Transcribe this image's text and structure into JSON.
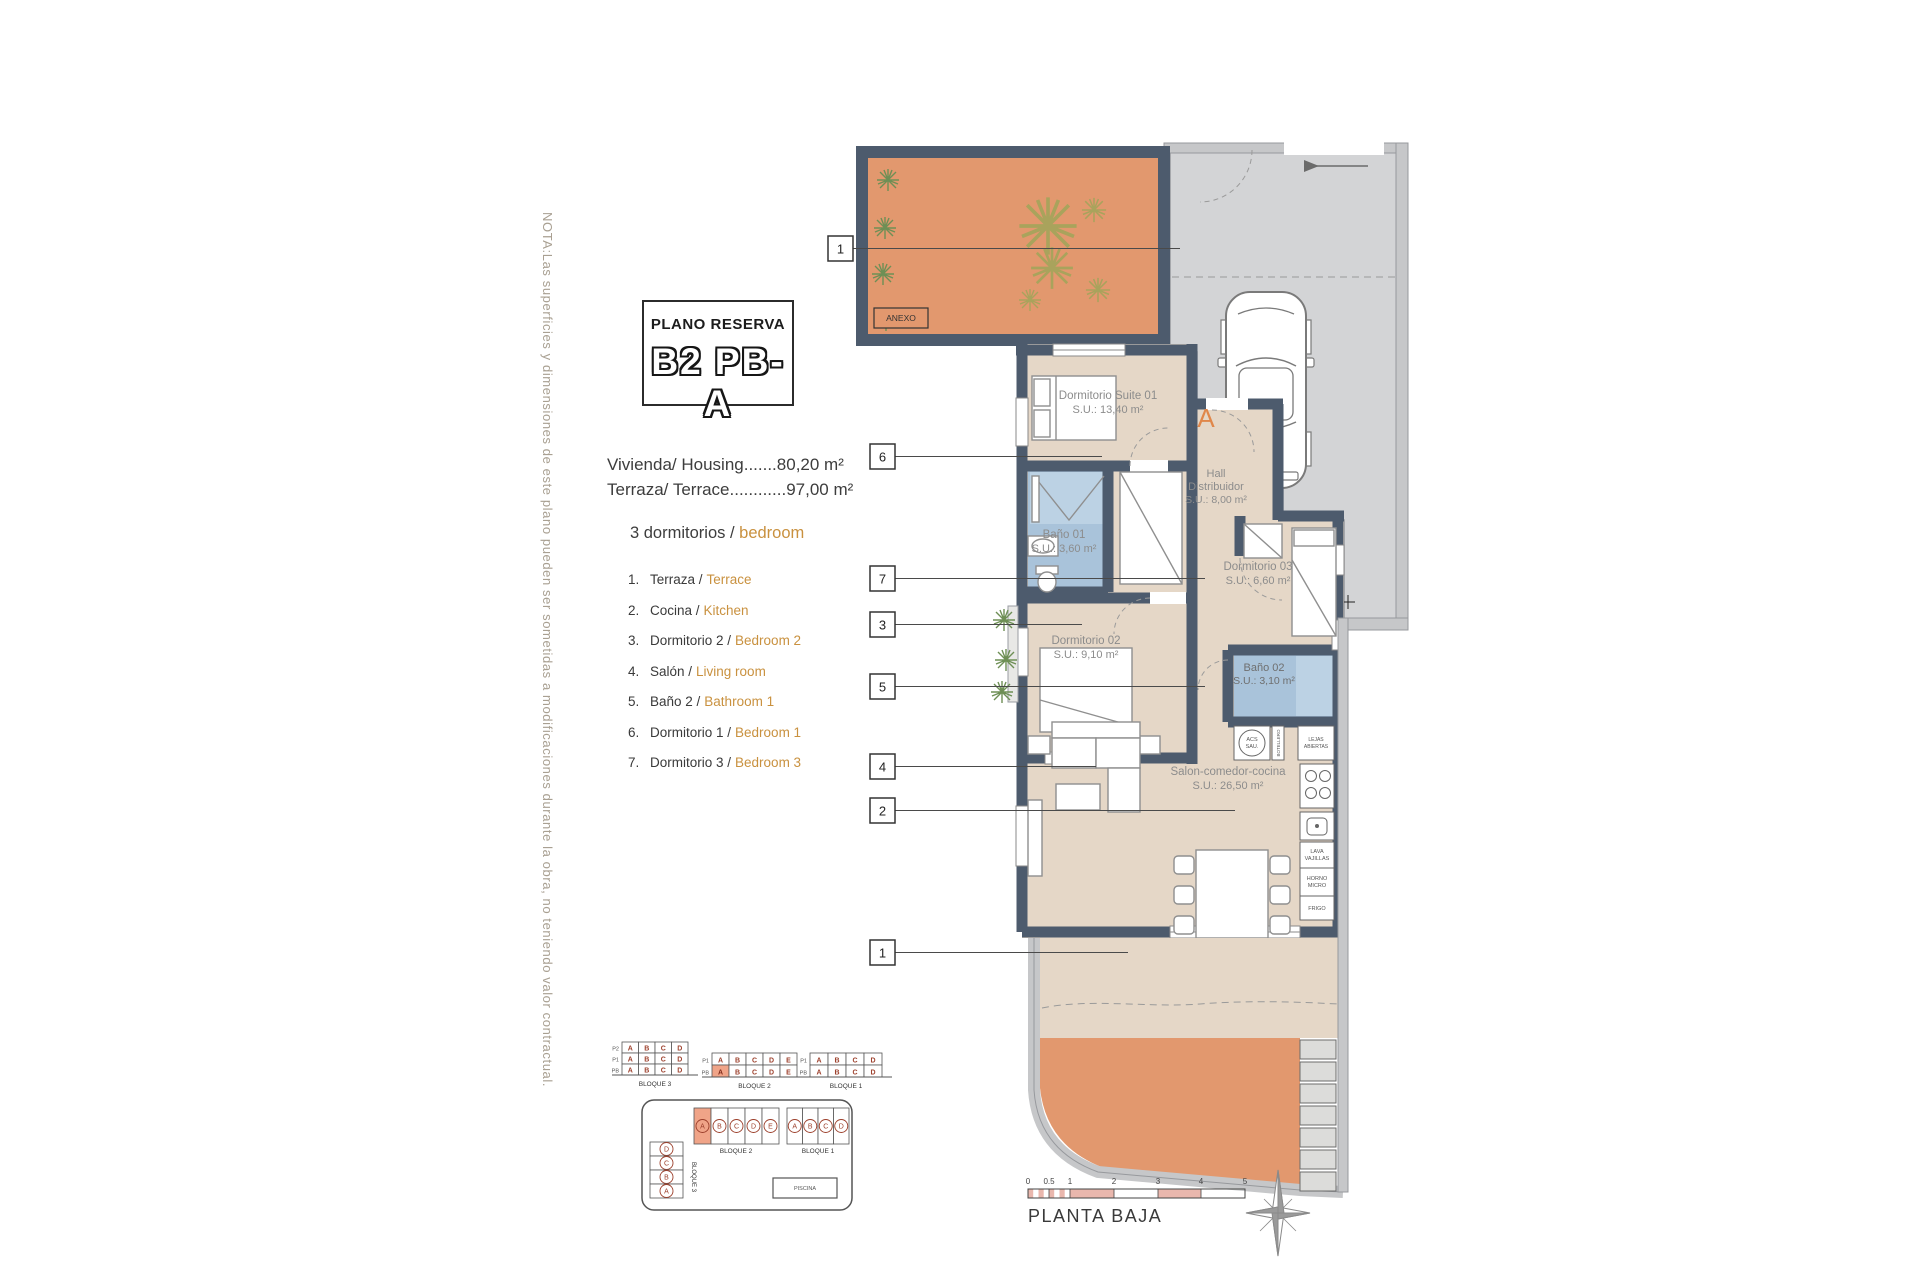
{
  "note": "NOTA:Las superficies y dimensiones de este plano pueden ser sometidas a modificaciones durante la obra, no teniendo valor contractual.",
  "title": {
    "kicker": "PLANO RESERVA",
    "code": "B2 PB-A"
  },
  "areas": {
    "housing": "Vivienda/ Housing.......80,20 m²",
    "terrace": "Terraza/ Terrace............97,00 m²"
  },
  "bedrooms": {
    "es": "3 dormitorios /",
    "en": "bedroom"
  },
  "legend": [
    {
      "n": "1.",
      "es": "Terraza /",
      "en": "Terrace"
    },
    {
      "n": "2.",
      "es": "Cocina /",
      "en": "Kitchen"
    },
    {
      "n": "3.",
      "es": "Dormitorio 2 /",
      "en": "Bedroom 2"
    },
    {
      "n": "4.",
      "es": "Salón /",
      "en": "Living room"
    },
    {
      "n": "5.",
      "es": "Baño 2 /",
      "en": "Bathroom 1"
    },
    {
      "n": "6.",
      "es": "Dormitorio 1 /",
      "en": "Bedroom 1"
    },
    {
      "n": "7.",
      "es": "Dormitorio 3 /",
      "en": "Bedroom 3"
    }
  ],
  "plan": {
    "entry_letter": "A",
    "terrace_tag": "ANEXO",
    "rooms": {
      "suite": {
        "name": "Dormitorio Suite 01",
        "area": "S.U.: 13,40 m²"
      },
      "hall": {
        "name1": "Hall",
        "name2": "Distribuidor",
        "area": "S.U.: 8,00 m²"
      },
      "bano1": {
        "name": "Baño 01",
        "area": "S.U.: 3,60 m²"
      },
      "dorm3": {
        "name": "Dormitorio 03",
        "area": "S.U.: 6,60 m²"
      },
      "dorm2": {
        "name": "Dormitorio 02",
        "area": "S.U.: 9,10 m²"
      },
      "bano2": {
        "name": "Baño 02",
        "area": "S.U.: 3,10 m²"
      },
      "salon": {
        "name": "Salon-comedor-cocina",
        "area": "S.U.: 26,50 m²"
      }
    },
    "kitchen": {
      "acs1": "ACS",
      "acs2": "SAU.",
      "botellero": "BOTELLERO",
      "baldas1": "LEJAS",
      "baldas2": "ABIERTAS",
      "lava1": "LAVA",
      "lava2": "VAJILLAS",
      "horno1": "HORNO",
      "horno2": "MICRO",
      "frigo": "FRIGO"
    },
    "callouts": [
      "1",
      "6",
      "7",
      "3",
      "5",
      "4",
      "2",
      "1"
    ]
  },
  "key": {
    "bloque3": {
      "caption": "BLOQUE 3",
      "rows": [
        "P2",
        "P1",
        "PB"
      ],
      "cols": [
        "A",
        "B",
        "C",
        "D"
      ],
      "highlight": null
    },
    "bloque2": {
      "caption": "BLOQUE 2",
      "rows": [
        "P1",
        "PB"
      ],
      "cols": [
        "A",
        "B",
        "C",
        "D",
        "E"
      ],
      "highlight": {
        "row": 1,
        "col": 0
      }
    },
    "bloque1": {
      "caption": "BLOQUE 1",
      "rows": [
        "P1",
        "PB"
      ],
      "cols": [
        "A",
        "B",
        "C",
        "D"
      ],
      "highlight": null
    }
  },
  "site": {
    "bloque2": {
      "caption": "BLOQUE 2",
      "units": [
        "A",
        "B",
        "C",
        "D",
        "E"
      ],
      "highlight": 0
    },
    "bloque1": {
      "caption": "BLOQUE 1",
      "units": [
        "A",
        "B",
        "C",
        "D"
      ],
      "highlight": -1
    },
    "bloque3": {
      "caption": "BLOQUE 3",
      "units": [
        "D",
        "C",
        "B",
        "A"
      ]
    },
    "pool": "PISCINA"
  },
  "footer": {
    "plan_name": "PLANTA BAJA",
    "scale_ticks": [
      "0",
      "0.5",
      "1",
      "2",
      "3",
      "4",
      "5"
    ]
  },
  "colors": {
    "wall": "#4d5b6d",
    "terracotta": "#e2986e",
    "floor": "#e5d7c7",
    "bath": "#a9c3da",
    "driveway": "#d3d4d6",
    "outer_wall": "#c6c7c9",
    "accent": "#c9913f",
    "entry": "#e0874a",
    "key_red": "#9c3f2b",
    "key_highlight": "#f0a488",
    "scale_pink": "#e9b7ad"
  }
}
